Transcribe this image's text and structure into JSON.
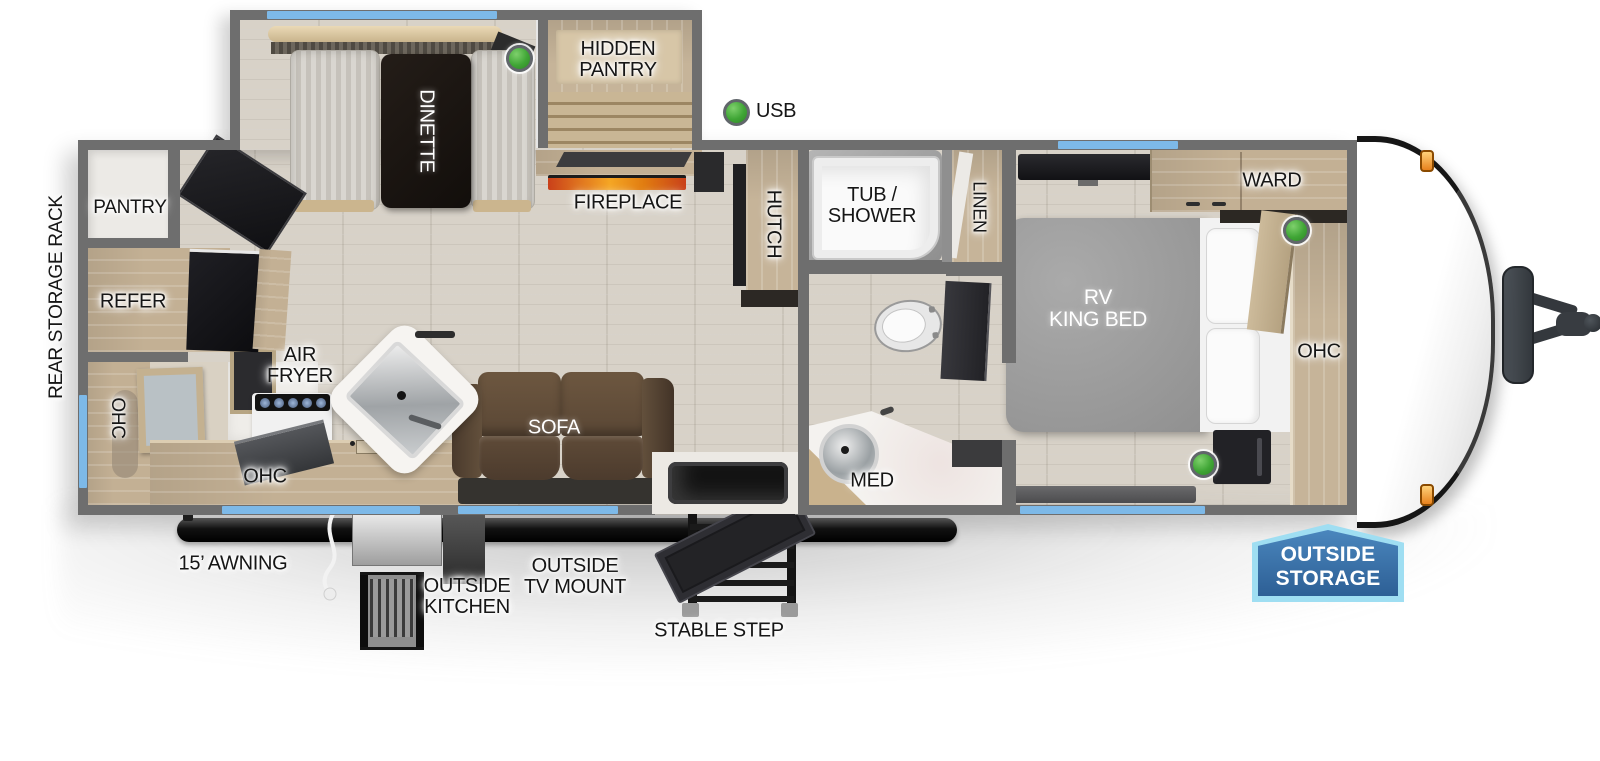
{
  "colors": {
    "wall_gray": "#6e6e6e",
    "window_blue": "#7db9e8",
    "green_indicator": "#43a536",
    "flame_orange": "#e8731c",
    "badge_blue": "#2d5f95",
    "badge_border": "#9fdef2",
    "sofa_brown": "#5d4936",
    "wood_cabinet": "#c6b79e",
    "floor_wood": "#d8d2c8",
    "marker_light_orange": "#e8821d"
  },
  "labels": {
    "rear_storage_rack": "REAR STORAGE RACK",
    "pantry": "PANTRY",
    "refer": "REFER",
    "ohc_rear": "OHC",
    "air_fryer": "AIR\nFRYER",
    "ohc_kitchen": "OHC",
    "dinette": "DINETTE",
    "hidden_pantry": "HIDDEN\nPANTRY",
    "usb": "USB",
    "fireplace": "FIREPLACE",
    "hutch": "HUTCH",
    "sofa": "SOFA",
    "tub_shower": "TUB /\nSHOWER",
    "linen": "LINEN",
    "med": "MED",
    "rv_king_bed": "RV\nKING BED",
    "ward": "WARD",
    "ohc_bedroom": "OHC",
    "awning": "15’ AWNING",
    "outside_kitchen": "OUTSIDE\nKITCHEN",
    "outside_tv_mount": "OUTSIDE\nTV MOUNT",
    "stable_step": "STABLE STEP",
    "outside_storage": "OUTSIDE\nSTORAGE"
  }
}
